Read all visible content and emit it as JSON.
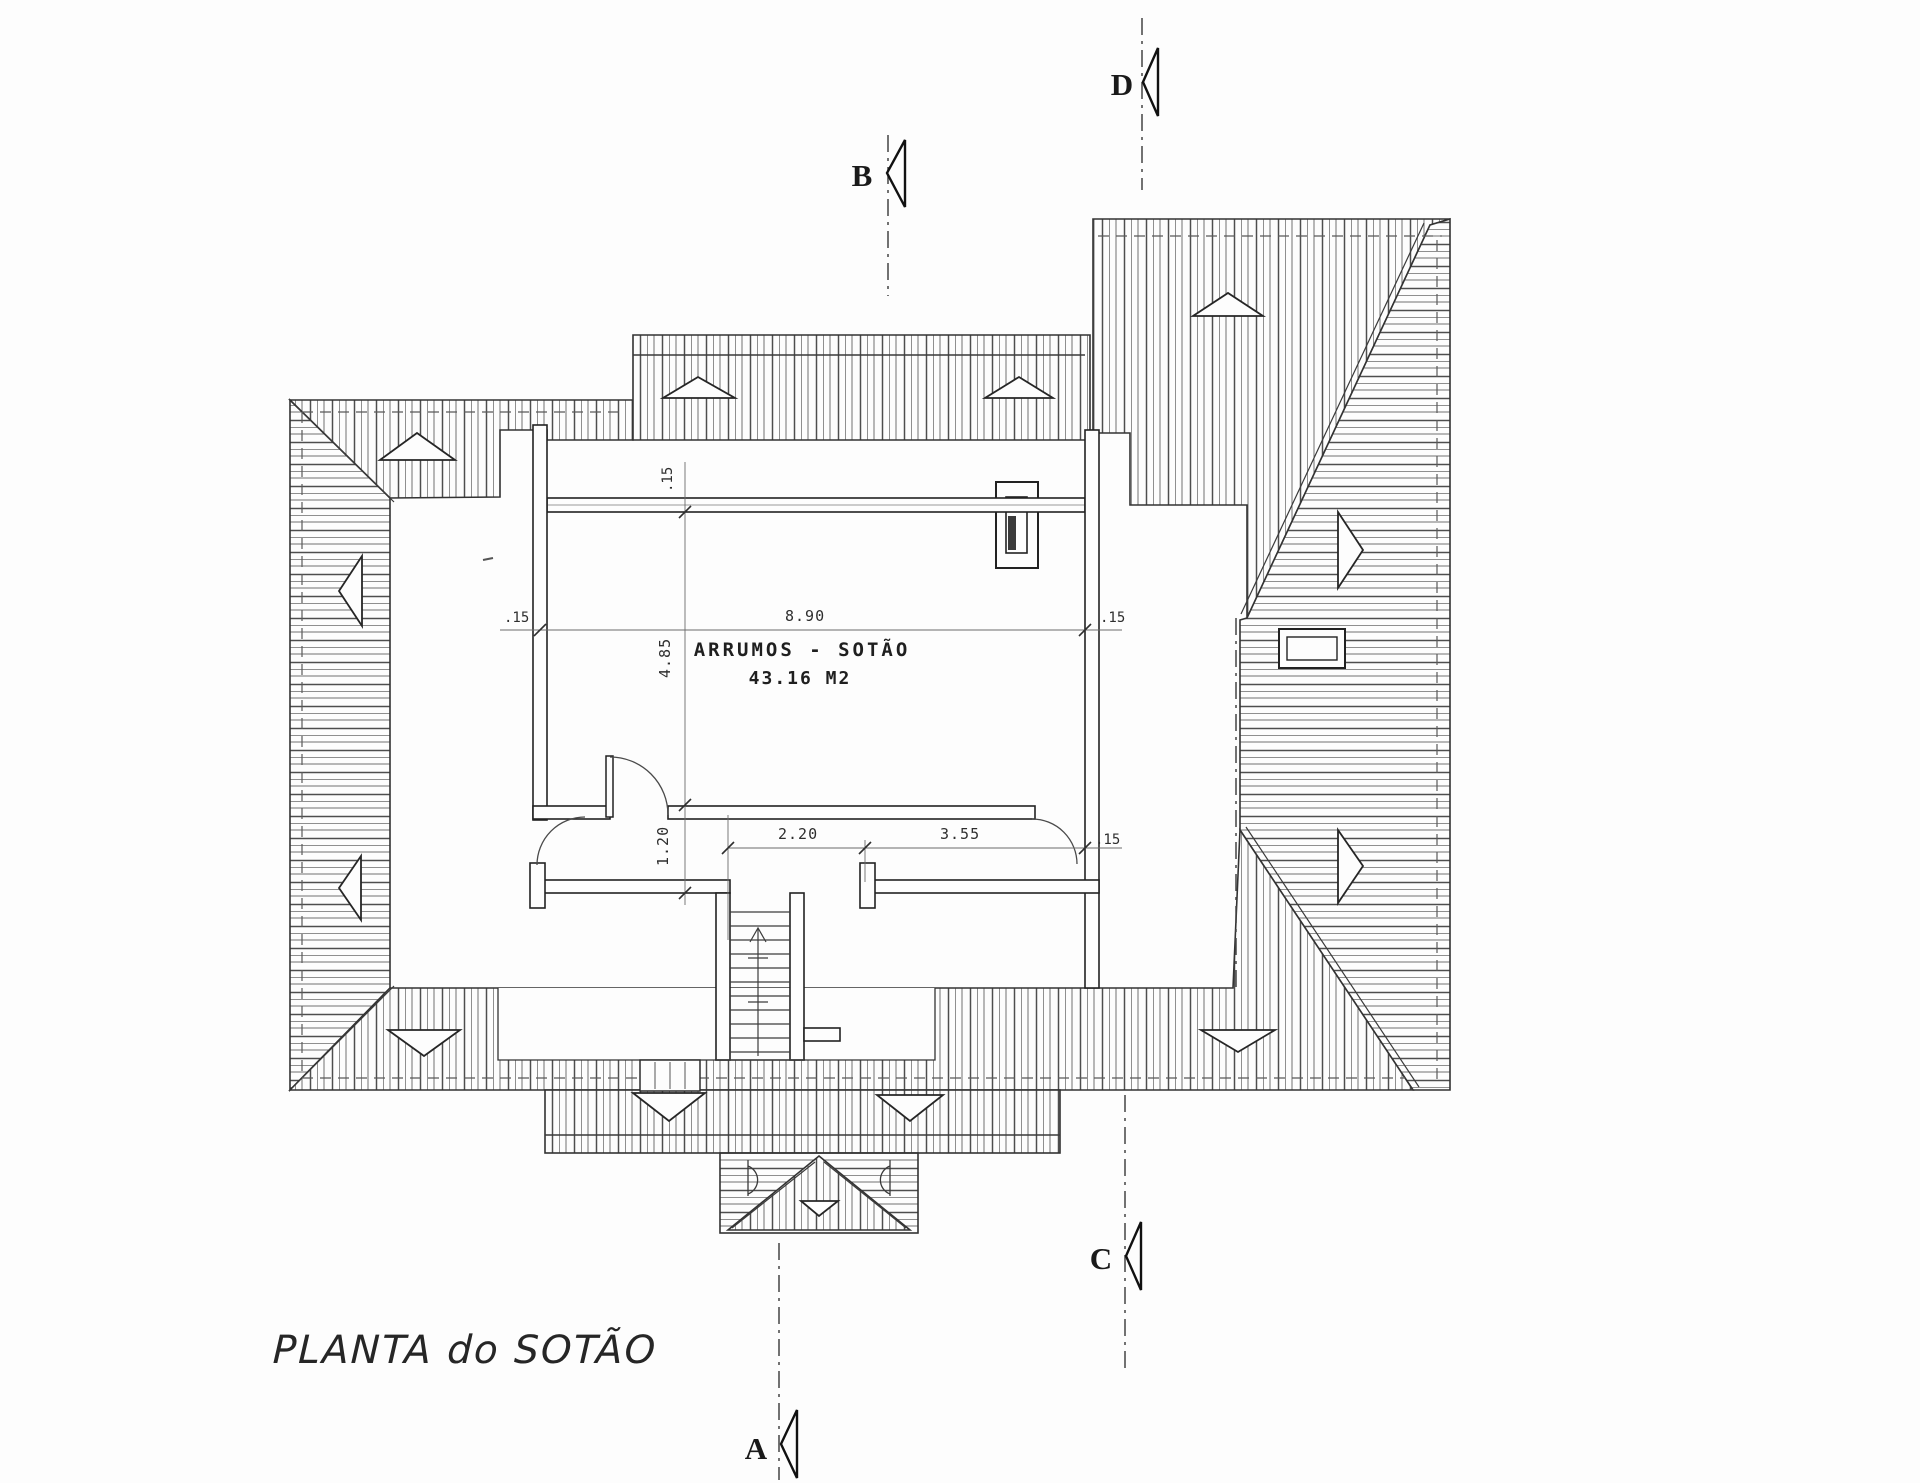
{
  "drawing": {
    "title": "PLANTA do SOTÃO",
    "room": {
      "label": "ARRUMOS - SOTÃO",
      "area": "43.16 M2"
    },
    "dimensions": {
      "room_width": "8.90",
      "room_depth": "4.85",
      "hall_depth": "1.20",
      "stair_bay_width": "2.20",
      "hall_width": "3.55",
      "wall_left": ".15",
      "wall_right": ".15",
      "wall_top": ".15",
      "wall_hall_right": ".15"
    },
    "section_markers": {
      "a": "A",
      "b": "B",
      "c": "C",
      "d": "D"
    },
    "colors": {
      "paper": "#fdfdfd",
      "line": "#2d2d2d",
      "hatch": "#6e6e6e",
      "dimension": "#3a3a3a"
    }
  }
}
